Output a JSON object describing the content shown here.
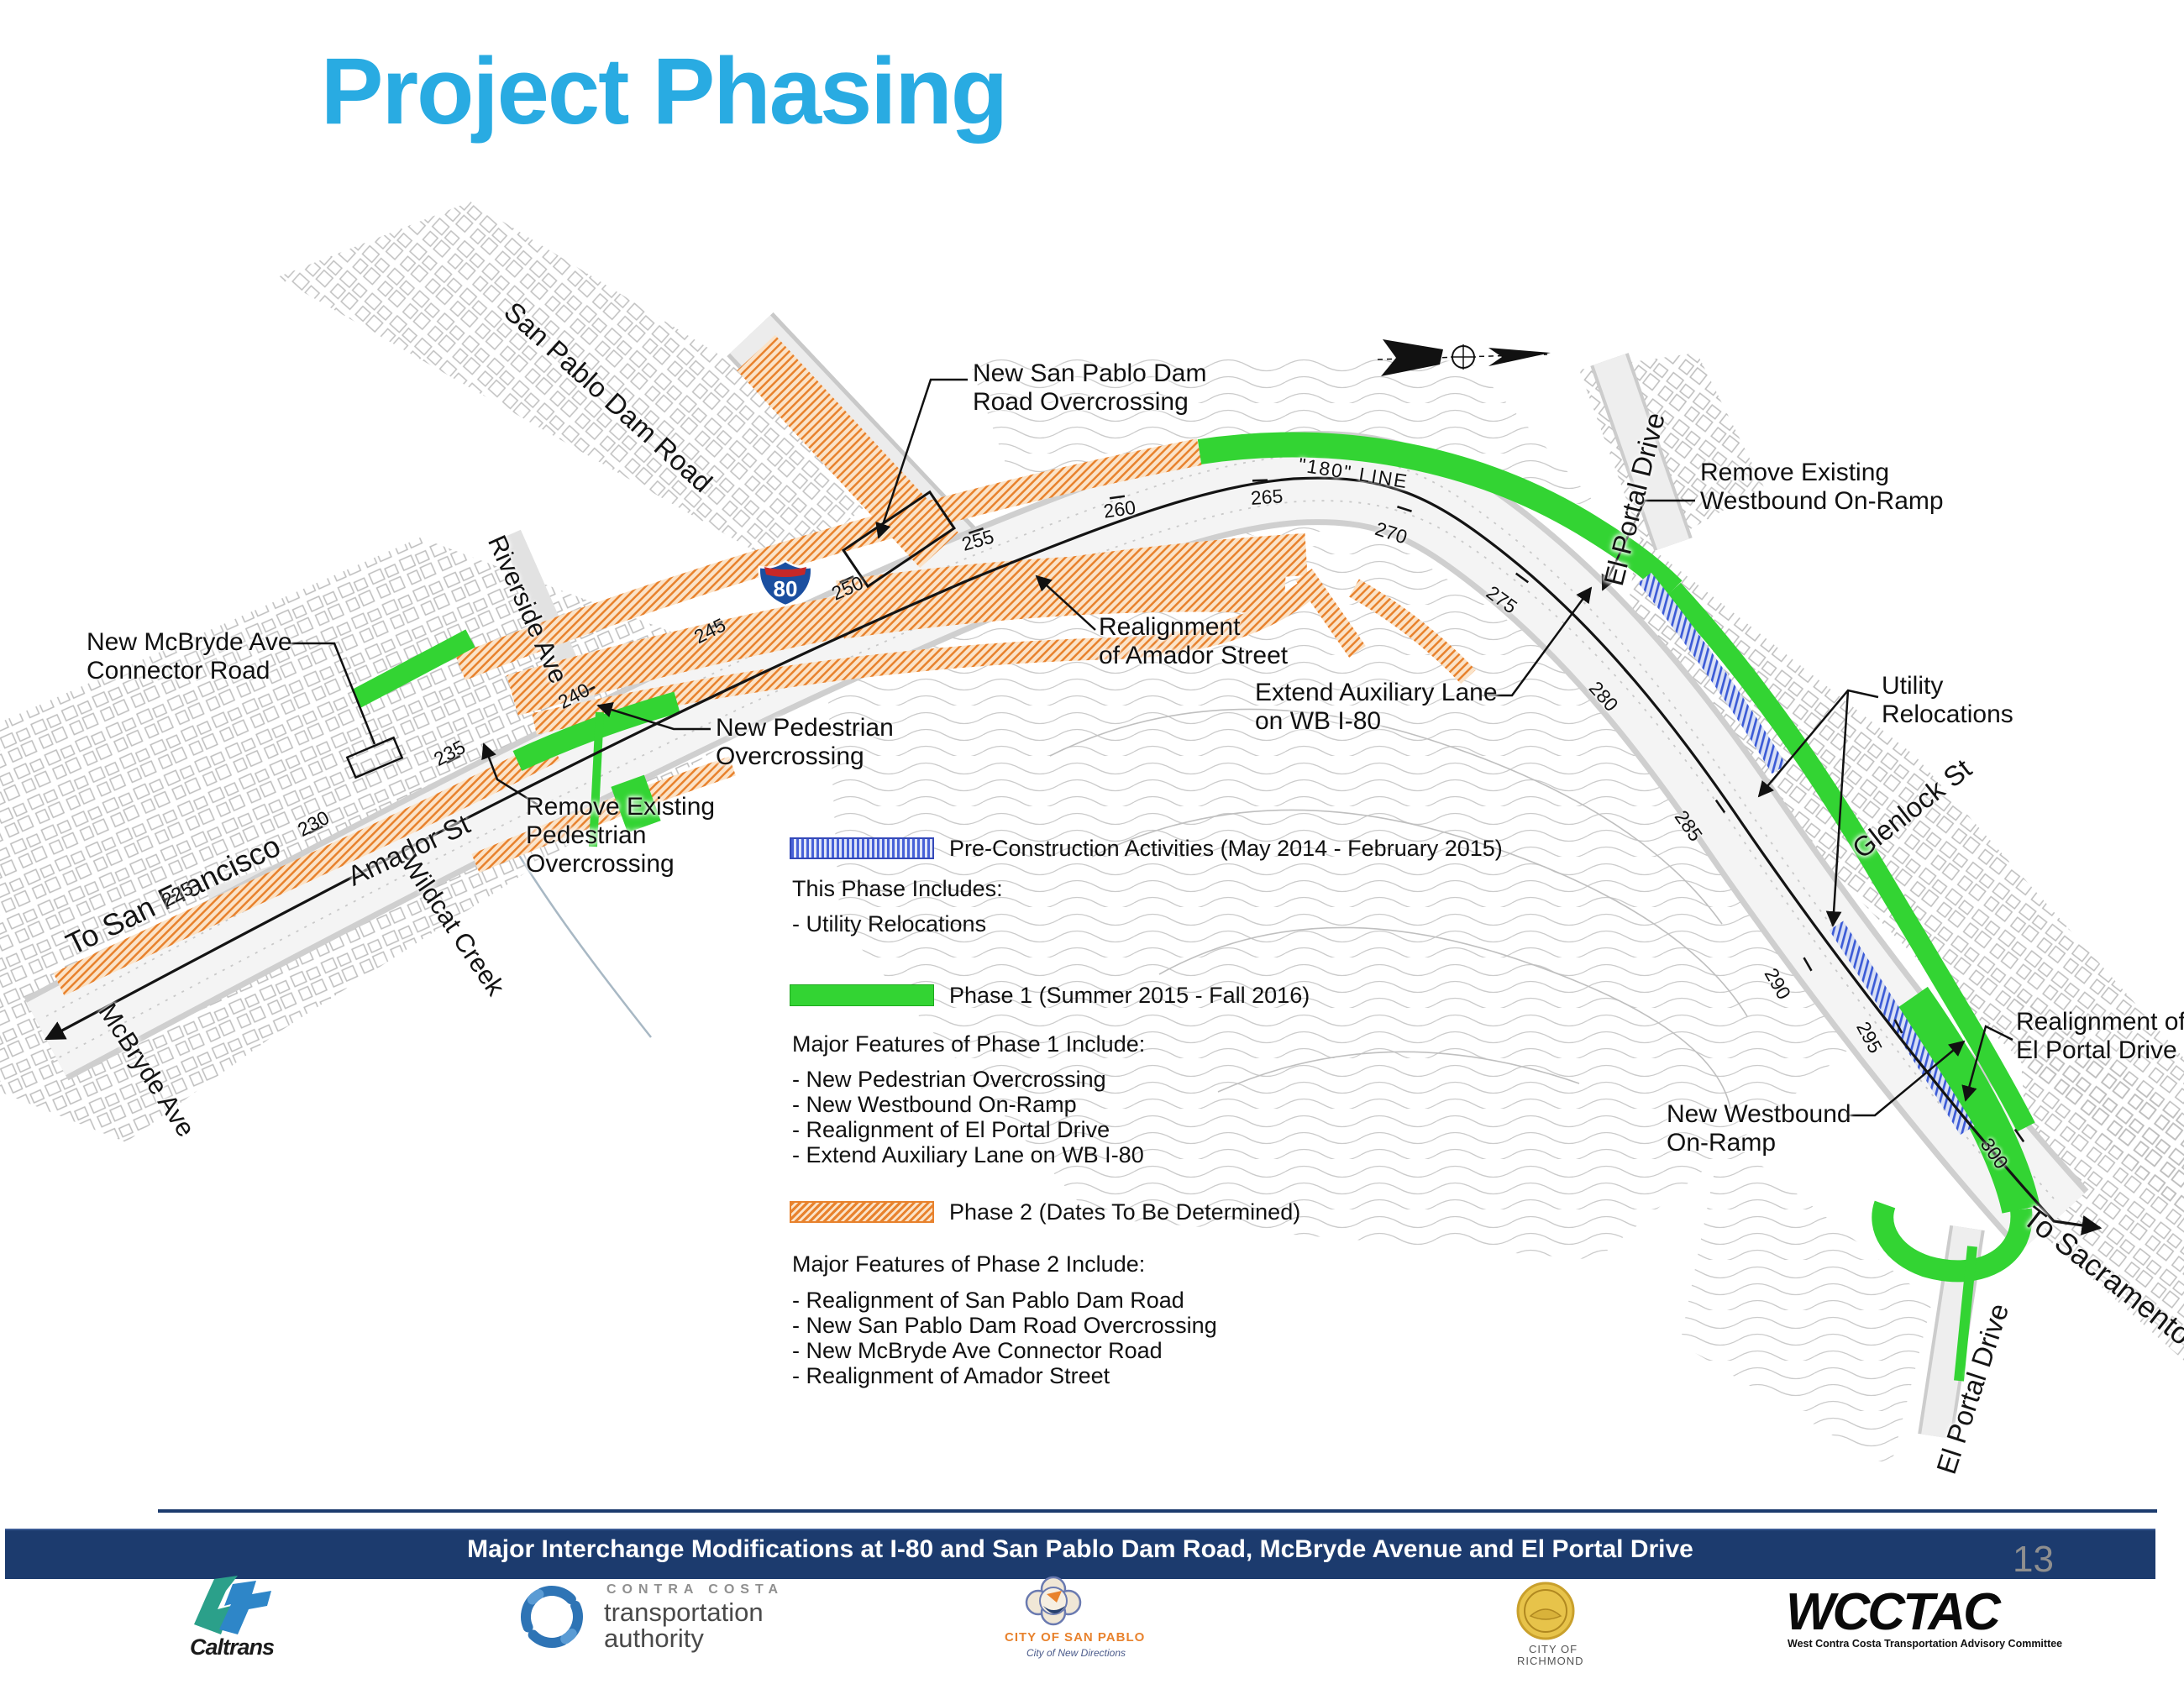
{
  "title": "Project Phasing",
  "colors": {
    "title_blue": "#29ABE2",
    "phase1_green": "#33D433",
    "phase2_orange": "#E8822D",
    "preconstruction_blue": "#4762D8",
    "footer_navy": "#1C3B6E"
  },
  "map": {
    "shield_label": "80",
    "line_label": "\"180\" LINE",
    "stations": [
      "225",
      "230",
      "235",
      "240",
      "245",
      "250",
      "255",
      "260",
      "265",
      "270",
      "275",
      "280",
      "285",
      "290",
      "295",
      "300"
    ],
    "streets": {
      "san_pablo_dam_road": "San Pablo Dam Road",
      "riverside_ave": "Riverside Ave",
      "el_portal_drive_top": "El Portal Drive",
      "glenlock_st": "Glenlock St",
      "amador_st": "Amador St",
      "wildcat_creek": "Wildcat Creek",
      "mcbryde_ave": "McBryde Ave",
      "to_san_francisco": "To San Francisco",
      "to_sacramento": "To Sacramento",
      "el_portal_drive_bottom": "El Portal Drive"
    },
    "callouts": {
      "new_spdr_overcrossing": [
        "New San Pablo Dam",
        "Road Overcrossing"
      ],
      "new_mcbryde_connector": [
        "New McBryde Ave",
        "Connector Road"
      ],
      "remove_existing_wb_onramp": [
        "Remove Existing",
        "Westbound On-Ramp"
      ],
      "realignment_amador": [
        "Realignment",
        "of Amador Street"
      ],
      "extend_aux_lane": [
        "Extend Auxiliary Lane",
        "on WB I-80"
      ],
      "utility_relocations": [
        "Utility",
        "Relocations"
      ],
      "new_ped_overcrossing": [
        "New Pedestrian",
        "Overcrossing"
      ],
      "remove_existing_ped_overcrossing": [
        "Remove Existing",
        "Pedestrian",
        "Overcrossing"
      ],
      "realignment_el_portal": [
        "Realignment of",
        "El Portal Drive"
      ],
      "new_wb_onramp": [
        "New Westbound",
        "On-Ramp"
      ]
    }
  },
  "legend": {
    "preconstruction": {
      "title": "Pre-Construction Activities (May 2014 - February 2015)",
      "subtitle": "This Phase Includes:",
      "items": [
        "- Utility Relocations"
      ]
    },
    "phase1": {
      "title": "Phase 1 (Summer 2015 - Fall 2016)",
      "subtitle": "Major Features of Phase 1 Include:",
      "items": [
        "- New Pedestrian Overcrossing",
        "- New Westbound On-Ramp",
        "- Realignment of El Portal Drive",
        "- Extend Auxiliary Lane on WB I-80"
      ]
    },
    "phase2": {
      "title": "Phase 2 (Dates To Be Determined)",
      "subtitle": "Major Features of Phase 2 Include:",
      "items": [
        "- Realignment of San Pablo Dam Road",
        "- New San Pablo Dam Road Overcrossing",
        "- New McBryde Ave Connector Road",
        "- Realignment of Amador Street"
      ]
    }
  },
  "footer": {
    "banner": "Major Interchange Modifications at I-80 and San Pablo Dam Road, McBryde Avenue and El Portal Drive",
    "page_number": "13",
    "logos": {
      "caltrans": "Caltrans",
      "ccta_top": "CONTRA COSTA",
      "ccta_line1": "transportation",
      "ccta_line2": "authority",
      "san_pablo_caption": "CITY OF SAN PABLO",
      "san_pablo_tagline": "City of New Directions",
      "richmond_line1": "CITY OF",
      "richmond_line2": "RICHMOND",
      "wcctac": "WCCTAC",
      "wcctac_caption": "West Contra Costa Transportation Advisory Committee"
    }
  }
}
